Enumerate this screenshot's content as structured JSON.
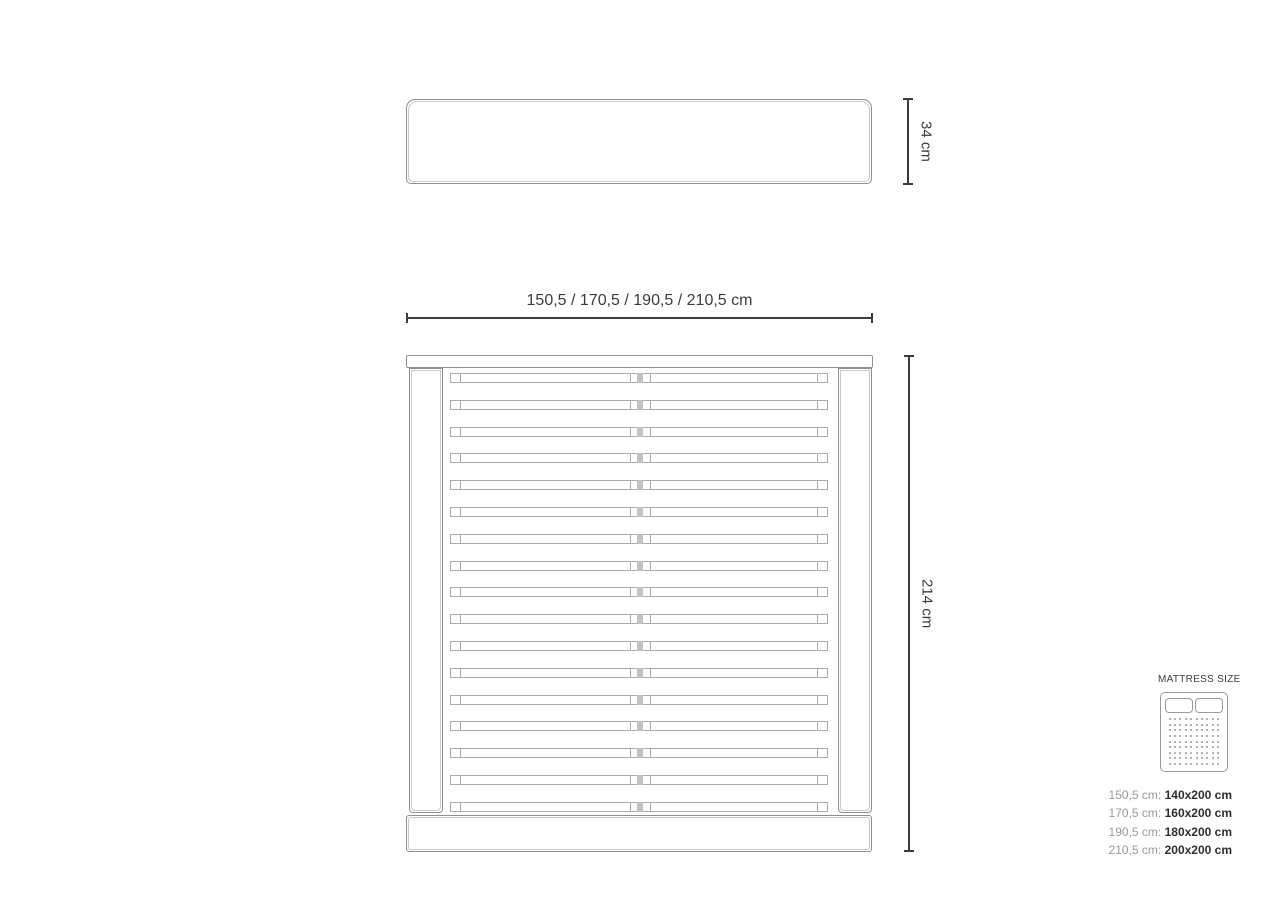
{
  "dimensions": {
    "headboard_height_label": "34 cm",
    "width_label": "150,5 / 170,5 / 190,5 / 210,5 cm",
    "length_label": "214 cm"
  },
  "bed_frame": {
    "slat_count": 17
  },
  "legend": {
    "title": "MATTRESS SIZE",
    "icon": {
      "pillow_count": 2,
      "dot_rows": 9,
      "dot_cols": 10
    },
    "rows": [
      {
        "frame_width": "150,5 cm:",
        "mattress_size": "140x200 cm"
      },
      {
        "frame_width": "170,5 cm:",
        "mattress_size": "160x200 cm"
      },
      {
        "frame_width": "190,5 cm:",
        "mattress_size": "180x200 cm"
      },
      {
        "frame_width": "210,5 cm:",
        "mattress_size": "200x200 cm"
      }
    ]
  },
  "colors": {
    "outline": "#8f8f8f",
    "outline_inner": "#c9c9c9",
    "slat_line": "#ababab",
    "dimension": "#3c3c3c",
    "legend_gray": "#9a9a9a",
    "legend_dark": "#2e2e2e"
  }
}
